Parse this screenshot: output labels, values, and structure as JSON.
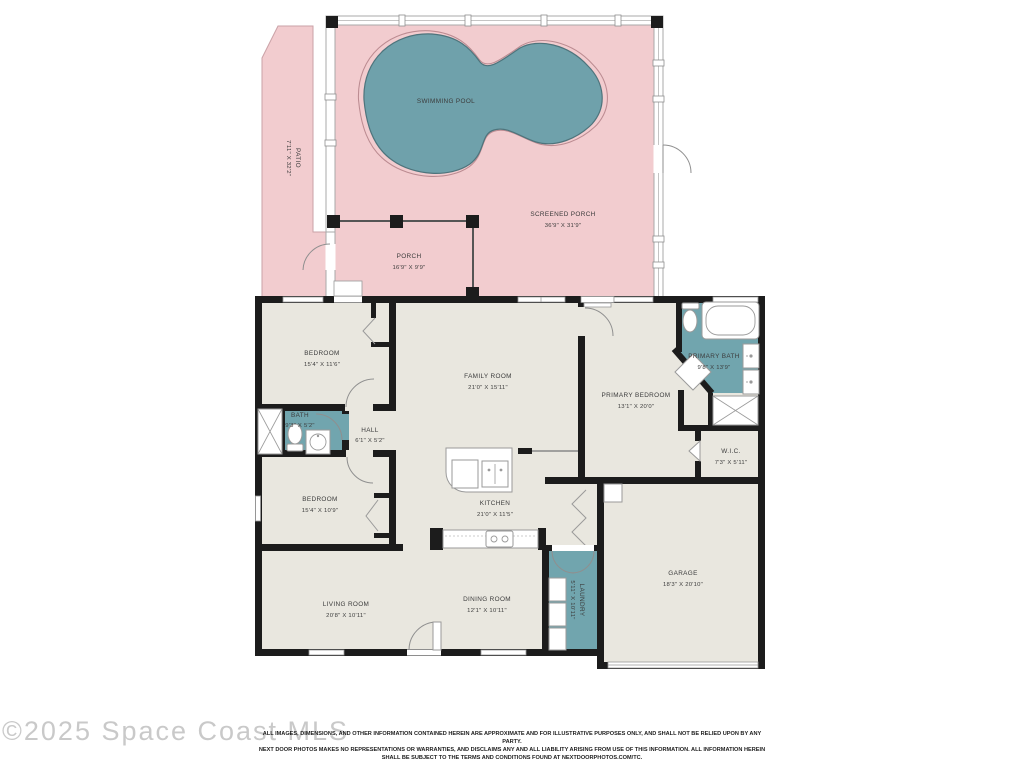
{
  "colors": {
    "outdoor_pink": "#f2cccf",
    "pool_teal": "#6fa1ab",
    "pool_edge": "#4e747c",
    "wet_room_teal": "#71a5ae",
    "room_fill": "#e9e7df",
    "wall_black": "#1c1c1c",
    "watermark_gray": "#c9c9c9"
  },
  "rooms": {
    "swimming_pool": {
      "label": "SWIMMING POOL",
      "dims": ""
    },
    "patio": {
      "label": "PATIO",
      "dims": "7'11\" X 32'2\""
    },
    "screened_porch": {
      "label": "SCREENED PORCH",
      "dims": "36'9\" X 31'9\""
    },
    "porch": {
      "label": "PORCH",
      "dims": "16'9\" X 9'9\""
    },
    "bedroom1": {
      "label": "BEDROOM",
      "dims": "15'4\" X 11'6\""
    },
    "family_room": {
      "label": "FAMILY ROOM",
      "dims": "21'0\" X 15'11\""
    },
    "primary_bedroom": {
      "label": "PRIMARY BEDROOM",
      "dims": "13'1\" X 20'0\""
    },
    "primary_bath": {
      "label": "PRIMARY BATH",
      "dims": "9'8\" X 13'9\""
    },
    "bath": {
      "label": "BATH",
      "dims": "9'3\" X 5'2\""
    },
    "hall": {
      "label": "HALL",
      "dims": "6'1\" X 5'2\""
    },
    "wic": {
      "label": "W.I.C.",
      "dims": "7'3\" X 5'11\""
    },
    "bedroom2": {
      "label": "BEDROOM",
      "dims": "15'4\" X 10'9\""
    },
    "kitchen": {
      "label": "KITCHEN",
      "dims": "21'0\" X 11'5\""
    },
    "living_room": {
      "label": "LIVING ROOM",
      "dims": "20'8\" X 10'11\""
    },
    "dining_room": {
      "label": "DINING ROOM",
      "dims": "12'1\" X 10'11\""
    },
    "laundry": {
      "label": "LAUNDRY",
      "dims": "5'11\" X 10'11\""
    },
    "garage": {
      "label": "GARAGE",
      "dims": "18'3\" X 20'10\""
    }
  },
  "footer": {
    "watermark": "©2025 Space Coast MLS",
    "disclaimer_line1": "ALL IMAGES, DIMENSIONS, AND OTHER INFORMATION CONTAINED HEREIN ARE APPROXIMATE AND FOR ILLUSTRATIVE PURPOSES ONLY, AND SHALL NOT BE RELIED UPON BY ANY PARTY.",
    "disclaimer_line2": "NEXT DOOR PHOTOS MAKES NO REPRESENTATIONS OR WARRANTIES, AND DISCLAIMS ANY AND ALL LIABILITY ARISING FROM USE OF THIS INFORMATION. ALL INFORMATION HEREIN",
    "disclaimer_line3": "SHALL BE SUBJECT TO THE TERMS AND CONDITIONS FOUND AT NEXTDOORPHOTOS.COM/TC."
  }
}
